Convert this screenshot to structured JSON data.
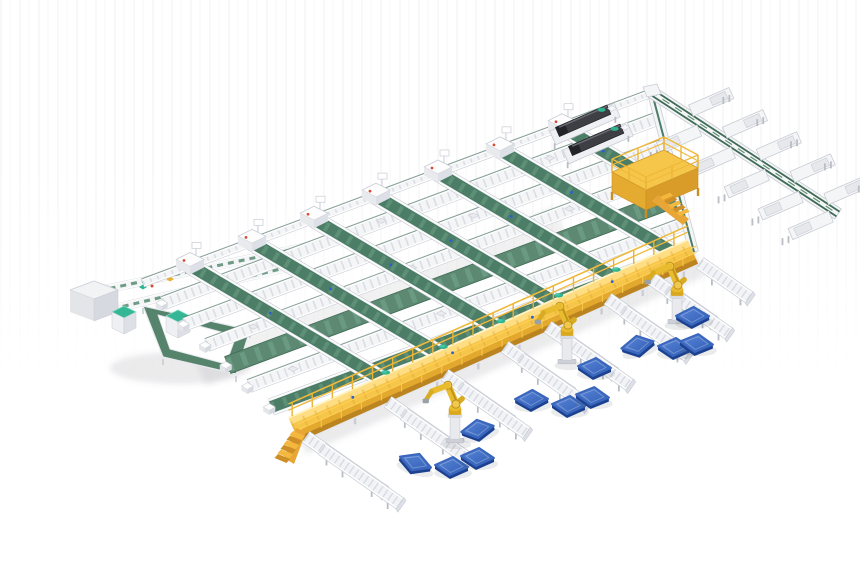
{
  "palette": {
    "white": "#f4f5f7",
    "railGray": "#c9ccd4",
    "rollerGray": "#dadde3",
    "legGray": "#b9bdc6",
    "trayGray": "#e9ebef",
    "beltGreen": "#4c7d66",
    "beltGreenLight": "#5e8f77",
    "beltGreenWide": "#5d8973",
    "beltEdge": "#3f6b55",
    "loopGreen": "#56836c",
    "teal": "#2fb491",
    "tealLight": "#49c8a6",
    "deckYellow": "#f6c64a",
    "deckLight": "#ffdf87",
    "deckShade": "#e3a92e",
    "deckFascia": "#bc8420",
    "railYellow": "#f0b93a",
    "stairOrange": "#e8a636",
    "stepLight": "#f4b83e",
    "stepDark": "#cf8f27",
    "robotYellow": "#e9bc2f",
    "robotShade": "#c0931a",
    "robotJoint": "#f0c94c",
    "robotBase": "#d9a81f",
    "pedestal": "#e8eaed",
    "palletTopA": "#5b87d8",
    "palletTopB": "#2f5db4",
    "palletSide": "#1c4190",
    "machineDark": "#3e3f44",
    "machineDarker": "#232428",
    "sensorBlue": "#2a5fd4",
    "redDot": "#d84b33",
    "shadow": "rgba(80,88,100,0.12)"
  },
  "canvas": {
    "w": 860,
    "h": 580
  },
  "lattice": {
    "top_line": {
      "x1": 143,
      "y1": 283,
      "x2": 652,
      "y2": 93
    },
    "right_edge": {
      "x1": 652,
      "y1": 93,
      "x2": 694,
      "y2": 252
    },
    "left_edge": {
      "x0": 143,
      "y0": 283,
      "slope": 1.034
    },
    "row_slope": -0.373,
    "row_end": {
      "a": 628.3,
      "b": 0.2548,
      "c": 1.095
    },
    "rows": [
      {
        "y": 303,
        "type": "roller"
      },
      {
        "y": 324,
        "type": "roller"
      },
      {
        "y": 345,
        "type": "roller"
      },
      {
        "y": 365,
        "type": "belt-wide"
      },
      {
        "y": 386,
        "type": "roller"
      },
      {
        "y": 407,
        "type": "belt"
      }
    ],
    "lanes": [
      {
        "x": 190
      },
      {
        "x": 252
      },
      {
        "x": 314
      },
      {
        "x": 376
      },
      {
        "x": 438
      },
      {
        "x": 500
      },
      {
        "x": 562,
        "cap": 120
      }
    ],
    "lane_end": {
      "a": 558.7,
      "b": 0.446,
      "c": 0.8936
    },
    "tray_fractions": [
      0.1,
      0.26,
      0.44,
      0.6,
      0.78,
      0.9
    ]
  },
  "walkway": {
    "x1": 293,
    "y1": 428,
    "x2": 692,
    "y2": 250,
    "deck_w": 22,
    "rail_h": 14,
    "leg_step": 45,
    "post_step": 22,
    "dots": [
      0.15,
      0.4,
      0.6,
      0.8
    ]
  },
  "return_line": {
    "x1": 650,
    "y1": 91,
    "x2": 838,
    "y2": 214,
    "chutes_ne": [
      0.2,
      0.38,
      0.56,
      0.74,
      0.92
    ],
    "chutes_sw": [
      0.28,
      0.46,
      0.64,
      0.82,
      0.98
    ]
  },
  "machines": [
    {
      "x": 585,
      "y": 124
    },
    {
      "x": 598,
      "y": 143
    }
  ],
  "platform": {
    "deck": [
      [
        612,
        172
      ],
      [
        664,
        150
      ],
      [
        698,
        168
      ],
      [
        646,
        190
      ]
    ],
    "depth": 20,
    "rail_h": 13,
    "stair_base": [
      660,
      197
    ],
    "steps": 5
  },
  "infeed": {
    "lines": [
      [
        88,
        293,
        310,
        246
      ],
      [
        112,
        309,
        302,
        264
      ]
    ],
    "dots": [
      [
        152,
        286
      ],
      [
        208,
        275
      ],
      [
        258,
        264
      ]
    ],
    "items": [
      {
        "x": 170,
        "y": 279,
        "color": "#e8b02e"
      },
      {
        "x": 143,
        "y": 287,
        "color": "#2fb491"
      }
    ]
  },
  "cabinet": {
    "top": [
      [
        70,
        290
      ],
      [
        94,
        281
      ],
      [
        118,
        290
      ],
      [
        94,
        299
      ]
    ],
    "depth": 22
  },
  "loop": {
    "outer": [
      [
        143,
        306
      ],
      [
        250,
        330
      ],
      [
        236,
        374
      ],
      [
        163,
        357
      ]
    ],
    "inner": [
      [
        158,
        315
      ],
      [
        236,
        336
      ],
      [
        226,
        364
      ],
      [
        170,
        349
      ]
    ],
    "cabinets": [
      {
        "x": 112,
        "y": 312
      },
      {
        "x": 166,
        "y": 316
      }
    ]
  },
  "spurs": [
    {
      "x": 306,
      "y": 437,
      "len": 95
    },
    {
      "x": 322,
      "y": 449,
      "len": 95
    },
    {
      "x": 388,
      "y": 402,
      "len": 80
    },
    {
      "x": 404,
      "y": 414,
      "len": 80
    },
    {
      "x": 445,
      "y": 375,
      "len": 80
    },
    {
      "x": 461,
      "y": 387,
      "len": 80
    },
    {
      "x": 505,
      "y": 347,
      "len": 80
    },
    {
      "x": 521,
      "y": 359,
      "len": 80
    },
    {
      "x": 548,
      "y": 327,
      "len": 80
    },
    {
      "x": 564,
      "y": 339,
      "len": 80
    },
    {
      "x": 608,
      "y": 299,
      "len": 78
    },
    {
      "x": 624,
      "y": 311,
      "len": 78
    },
    {
      "x": 652,
      "y": 279,
      "len": 74
    },
    {
      "x": 668,
      "y": 291,
      "len": 74
    },
    {
      "x": 700,
      "y": 263,
      "len": 60
    }
  ],
  "robots": [
    {
      "x": 455,
      "y": 441
    },
    {
      "x": 567,
      "y": 362
    },
    {
      "x": 677,
      "y": 322
    }
  ],
  "pallets": [
    {
      "x": 531,
      "y": 399,
      "r": -4
    },
    {
      "x": 568,
      "y": 405,
      "r": 0
    },
    {
      "x": 592,
      "y": 396,
      "r": 2
    },
    {
      "x": 477,
      "y": 429,
      "r": -14
    },
    {
      "x": 415,
      "y": 462,
      "r": 16
    },
    {
      "x": 451,
      "y": 466,
      "r": 0
    },
    {
      "x": 477,
      "y": 457,
      "r": 0
    },
    {
      "x": 692,
      "y": 316,
      "r": -3
    },
    {
      "x": 637,
      "y": 345,
      "r": -16
    },
    {
      "x": 674,
      "y": 347,
      "r": 0
    },
    {
      "x": 696,
      "y": 343,
      "r": 2
    },
    {
      "x": 594,
      "y": 367,
      "r": 0
    }
  ]
}
